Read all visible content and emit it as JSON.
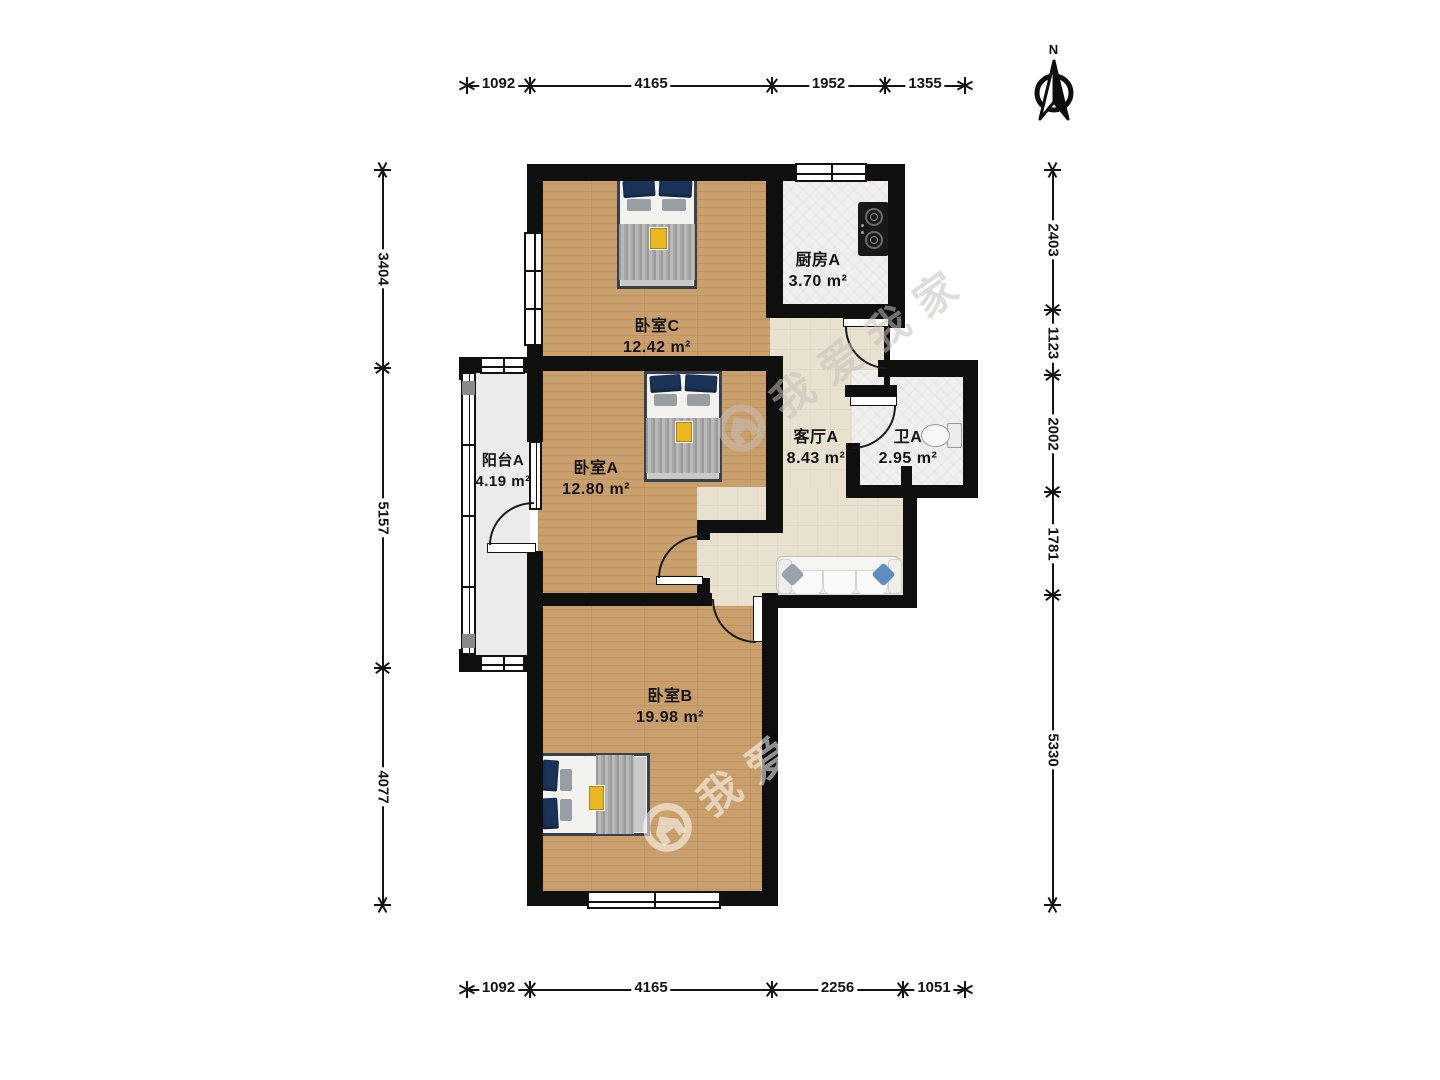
{
  "compass": {
    "label": "N"
  },
  "watermark": {
    "text": "我爱我家"
  },
  "rooms": {
    "bedroomC": {
      "name": "卧室C",
      "area": "12.42 m²"
    },
    "kitchen": {
      "name": "厨房A",
      "area": "3.70 m²"
    },
    "bedroomA": {
      "name": "卧室A",
      "area": "12.80 m²"
    },
    "living": {
      "name": "客厅A",
      "area": "8.43 m²"
    },
    "bath": {
      "name": "卫A",
      "area": "2.95 m²"
    },
    "balcony": {
      "name": "阳台A",
      "area": "4.19 m²"
    },
    "bedroomB": {
      "name": "卧室B",
      "area": "19.98 m²"
    }
  },
  "dimensions": {
    "top": {
      "orientation": "h",
      "pos": 86,
      "start": 467,
      "end": 965,
      "ticks": [
        467,
        530,
        772,
        885,
        965
      ],
      "labels": [
        "1092",
        "4165",
        "1952",
        "1355"
      ]
    },
    "bottom": {
      "orientation": "h",
      "pos": 990,
      "start": 467,
      "end": 965,
      "ticks": [
        467,
        530,
        772,
        903,
        965
      ],
      "labels": [
        "1092",
        "4165",
        "2256",
        "1051"
      ]
    },
    "left": {
      "orientation": "v",
      "pos": 383,
      "start": 170,
      "end": 905,
      "ticks": [
        170,
        368,
        668,
        905
      ],
      "labels": [
        "3404",
        "5157",
        "4077"
      ]
    },
    "right": {
      "orientation": "v",
      "pos": 1053,
      "start": 170,
      "end": 905,
      "ticks": [
        170,
        310,
        375,
        492,
        595,
        905
      ],
      "labels": [
        "2403",
        "1123",
        "2002",
        "1781",
        "5330"
      ]
    }
  },
  "colors": {
    "wall": "#0f0f0f",
    "wood": "#c9a06b",
    "hall_tile": "#e9e1cf",
    "white_tile": "#f0efee",
    "balcony": "#ebebeb",
    "bed_frame": "#3a414e",
    "pillow_navy": "#1b3358",
    "accent_yellow": "#eab723",
    "sofa_pillow_blue": "#5d8cc0",
    "sofa_pillow_gray": "#9aa2ac"
  }
}
